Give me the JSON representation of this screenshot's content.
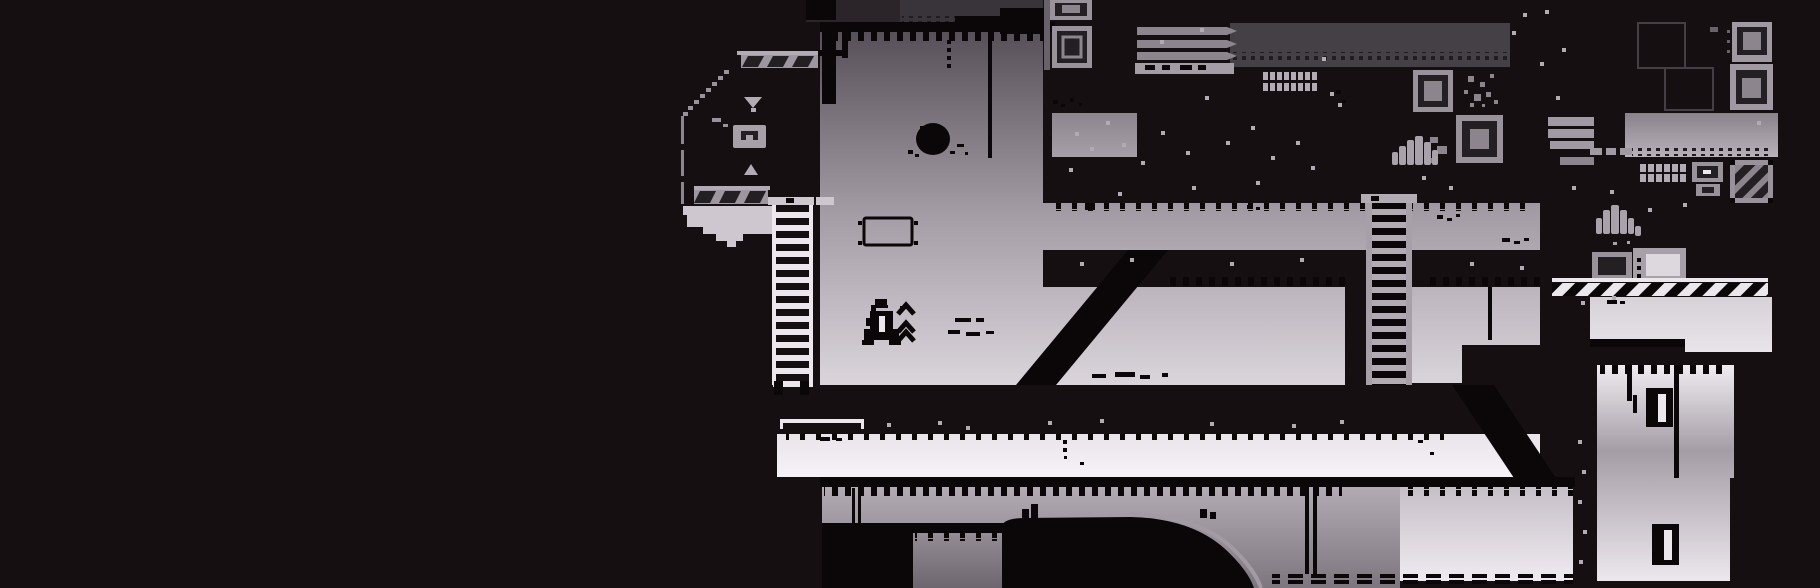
{
  "meta": {
    "content_type": "game-screenshot",
    "style": "1-bit monochrome pixel-art platformer level",
    "visible_text": "",
    "viewport": {
      "width": 1820,
      "height": 588
    }
  },
  "palette": {
    "void": "#150f12",
    "ink": "#0b0709",
    "topBand": "#2b2529",
    "overhang": "#39333a",
    "ceilingBand": "#453f46",
    "edgeGray": "#6a626a",
    "panelGray": "#9a929b",
    "midGray": "#8d858d",
    "lightGray": "#b3abb3",
    "paleGray": "#cfc7cf",
    "bright": "#ece6ed",
    "white": "#f8f3f9",
    "innerDark": "#241f22",
    "outline": "#453f45",
    "rimGray": "#a39ba4",
    "roomGradTop": "#544d55",
    "roomGradMid": "#a59da6",
    "roomGradBottom": "#f8f3f9"
  },
  "scene": {
    "regions": [
      {
        "name": "left-void",
        "desc": "empty black void occupying left third of screen"
      },
      {
        "name": "upper-alcove",
        "desc": "dark alcove with two diagonal-hatched platforms, down/up arrow indicators, meter box, stepped ledge"
      },
      {
        "name": "ladder-left",
        "desc": "white ladder from y198 to y395 at x775"
      },
      {
        "name": "main-room",
        "desc": "large gradient-lit room with creature blob, hanging wire, floating sign, player character"
      },
      {
        "name": "black-mass",
        "desc": "black structure with crate stack, vent slats, wall grate, white speckles"
      },
      {
        "name": "corridor",
        "desc": "horizontal lit corridor y203-250 from x1043 to x1540"
      },
      {
        "name": "ramp",
        "desc": "diagonal black ramp from corridor level down to floor"
      },
      {
        "name": "ladder-right",
        "desc": "gray ladder at x1366 crossing corridor down to floor band"
      },
      {
        "name": "walkway",
        "desc": "bright walkway band y434-477 with railing"
      },
      {
        "name": "underside",
        "desc": "gray under-floor strata with pipes, black mound, dashed bottom edge"
      },
      {
        "name": "right-platform-band",
        "desc": "gray platform band y113-157 with slat fingers"
      },
      {
        "name": "right-machinery",
        "desc": "wall grate, monitor panel, diagonal-striped hazard crate, machine boxes, hazard conveyor"
      },
      {
        "name": "tall-room",
        "desc": "tall lit room x1597-1733 with two hatch doors and hanging wires"
      },
      {
        "name": "player-character",
        "desc": "small black mech/rocket figure with triple jump chevrons",
        "x": 868,
        "y": 299
      }
    ],
    "speckles": [
      [
        1075,
        132
      ],
      [
        1090,
        147
      ],
      [
        1106,
        121
      ],
      [
        1122,
        143
      ],
      [
        1141,
        161
      ],
      [
        1161,
        131
      ],
      [
        1186,
        151
      ],
      [
        1205,
        96
      ],
      [
        1226,
        141
      ],
      [
        1251,
        126
      ],
      [
        1271,
        156
      ],
      [
        1296,
        141
      ],
      [
        1311,
        166
      ],
      [
        1322,
        57
      ],
      [
        1330,
        92
      ],
      [
        1338,
        103
      ],
      [
        1256,
        181
      ],
      [
        1192,
        186
      ],
      [
        1118,
        192
      ],
      [
        1069,
        168
      ],
      [
        1160,
        40
      ],
      [
        1200,
        28
      ],
      [
        1422,
        176
      ],
      [
        1449,
        186
      ],
      [
        1540,
        62
      ],
      [
        1556,
        96
      ],
      [
        1572,
        186
      ],
      [
        1610,
        190
      ],
      [
        1648,
        208
      ],
      [
        1683,
        203
      ],
      [
        1612,
        296
      ],
      [
        1581,
        301
      ],
      [
        1757,
        121
      ],
      [
        1512,
        31
      ],
      [
        1523,
        13
      ],
      [
        1545,
        10
      ],
      [
        1562,
        48
      ],
      [
        887,
        423
      ],
      [
        938,
        421
      ],
      [
        966,
        426
      ],
      [
        1048,
        421
      ],
      [
        1100,
        419
      ],
      [
        1210,
        422
      ],
      [
        1292,
        424
      ],
      [
        1340,
        420
      ],
      [
        1080,
        262
      ],
      [
        1130,
        258
      ],
      [
        1230,
        262
      ],
      [
        1300,
        258
      ],
      [
        1470,
        262
      ],
      [
        1520,
        266
      ],
      [
        1578,
        440
      ],
      [
        1582,
        470
      ],
      [
        1578,
        500
      ],
      [
        1583,
        530
      ],
      [
        1579,
        560
      ]
    ],
    "dust": [
      [
        955,
        318,
        16,
        4
      ],
      [
        976,
        318,
        8,
        4
      ],
      [
        948,
        330,
        12,
        4
      ],
      [
        966,
        332,
        14,
        4
      ],
      [
        986,
        331,
        8,
        3
      ],
      [
        820,
        437,
        10,
        4
      ],
      [
        836,
        438,
        6,
        3
      ],
      [
        1063,
        440,
        4,
        4
      ],
      [
        1063,
        448,
        4,
        4
      ],
      [
        1064,
        456,
        3,
        3
      ],
      [
        1080,
        462,
        4,
        3
      ],
      [
        1092,
        374,
        14,
        4
      ],
      [
        1115,
        372,
        20,
        5
      ],
      [
        1140,
        375,
        10,
        4
      ],
      [
        1162,
        373,
        6,
        4
      ],
      [
        1247,
        205,
        6,
        4
      ],
      [
        1256,
        207,
        4,
        3
      ],
      [
        1264,
        204,
        4,
        3
      ],
      [
        1053,
        100,
        5,
        4
      ],
      [
        1061,
        104,
        4,
        3
      ],
      [
        1070,
        98,
        4,
        4
      ],
      [
        1079,
        103,
        3,
        3
      ],
      [
        1502,
        238,
        8,
        4
      ],
      [
        1514,
        241,
        6,
        3
      ],
      [
        1524,
        238,
        5,
        3
      ],
      [
        1437,
        215,
        6,
        4
      ],
      [
        1447,
        218,
        5,
        3
      ],
      [
        1456,
        214,
        4,
        3
      ],
      [
        1607,
        300,
        10,
        4
      ],
      [
        1620,
        301,
        5,
        3
      ],
      [
        1336,
        90,
        5,
        4
      ],
      [
        1342,
        100,
        4,
        3
      ],
      [
        900,
        306,
        6,
        3
      ],
      [
        883,
        305,
        5,
        3
      ],
      [
        1418,
        440,
        5,
        3
      ],
      [
        1430,
        452,
        4,
        3
      ],
      [
        947,
        40,
        4,
        4
      ],
      [
        947,
        48,
        4,
        4
      ],
      [
        947,
        56,
        4,
        4
      ],
      [
        947,
        64,
        4,
        4
      ],
      [
        1085,
        203,
        10,
        7
      ],
      [
        1145,
        65,
        10,
        5
      ],
      [
        1162,
        65,
        8,
        5
      ],
      [
        1180,
        65,
        12,
        5
      ],
      [
        1198,
        65,
        8,
        5
      ]
    ]
  }
}
